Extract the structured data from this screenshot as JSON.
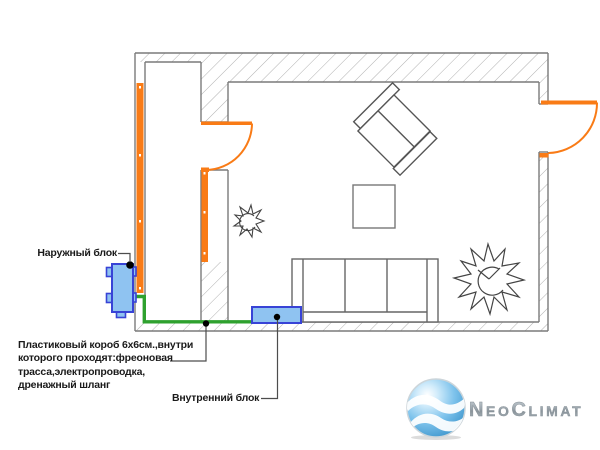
{
  "labels": {
    "outdoor_unit": "Наружный блок",
    "duct_note": "Пластиковый короб 6х6см.,внутри\nкоторого проходят:фреоновая\nтрасса,электропроводка,\nдренажный шланг",
    "indoor_unit": "Внутренний блок"
  },
  "logo": {
    "n": "N",
    "eo": "EO",
    "c": "C",
    "limat": "LIMAT"
  },
  "colors": {
    "wall_highlight_orange": "#F97B16",
    "duct_green": "#2EA12E",
    "unit_fill_blue": "#8FC3F1",
    "unit_border_blue": "#3843D6",
    "wall_line_gray": "#7a7a7a",
    "hatch_gray": "#b0b0b0",
    "logo_sphere_blue": "#5FB4E5",
    "logo_text_gray": "#98A2A8"
  }
}
